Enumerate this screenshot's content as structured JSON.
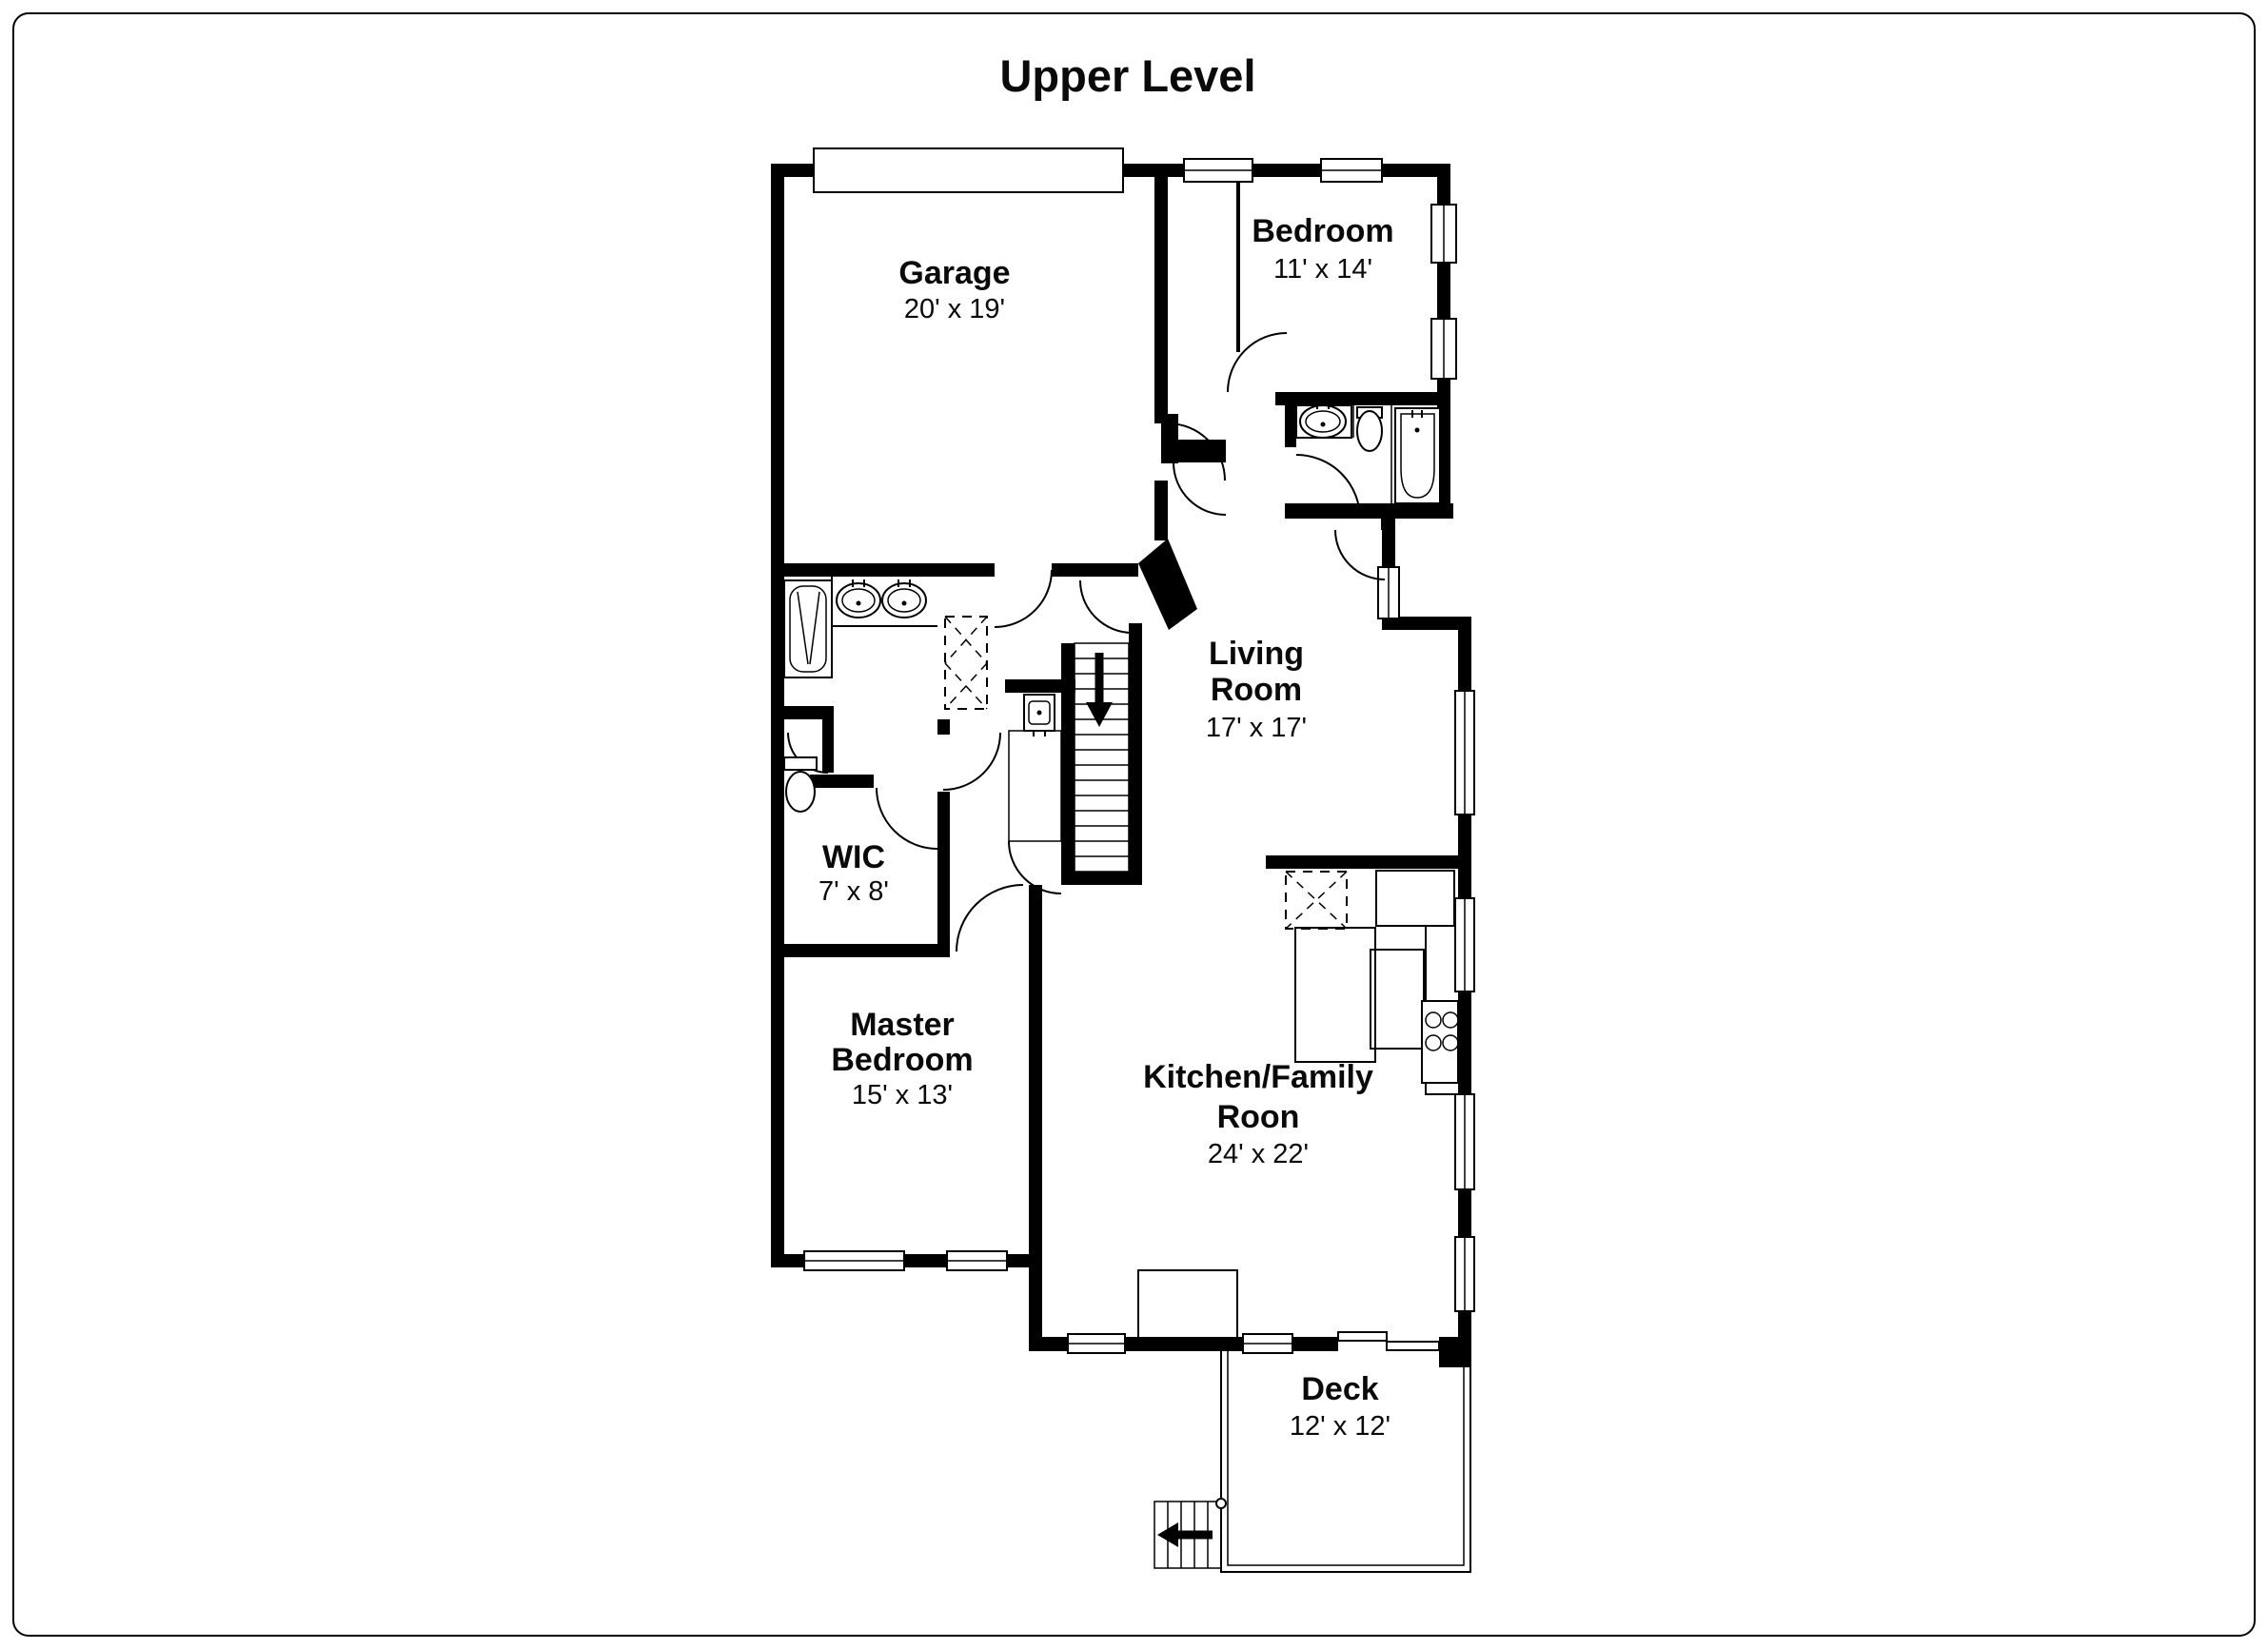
{
  "title": "Upper Level",
  "colors": {
    "walls": "#000000",
    "background": "#ffffff",
    "label_text": "#0a0a0a"
  },
  "rooms": [
    {
      "id": "garage",
      "name": "Garage",
      "dims": "20' x 19'"
    },
    {
      "id": "bedroom",
      "name": "Bedroom",
      "dims": "11' x 14'"
    },
    {
      "id": "living-room",
      "name_line1": "Living",
      "name_line2": "Room",
      "dims": "17' x 17'"
    },
    {
      "id": "wic",
      "name": "WIC",
      "dims": "7' x 8'"
    },
    {
      "id": "master-bedroom",
      "name_line1": "Master",
      "name_line2": "Bedroom",
      "dims": "15' x 13'"
    },
    {
      "id": "kitchen-family-room",
      "name_line1": "Kitchen/Family",
      "name_line2": "Roon",
      "dims": "24' x 22'"
    },
    {
      "id": "deck",
      "name": "Deck",
      "dims": "12' x 12'"
    }
  ]
}
